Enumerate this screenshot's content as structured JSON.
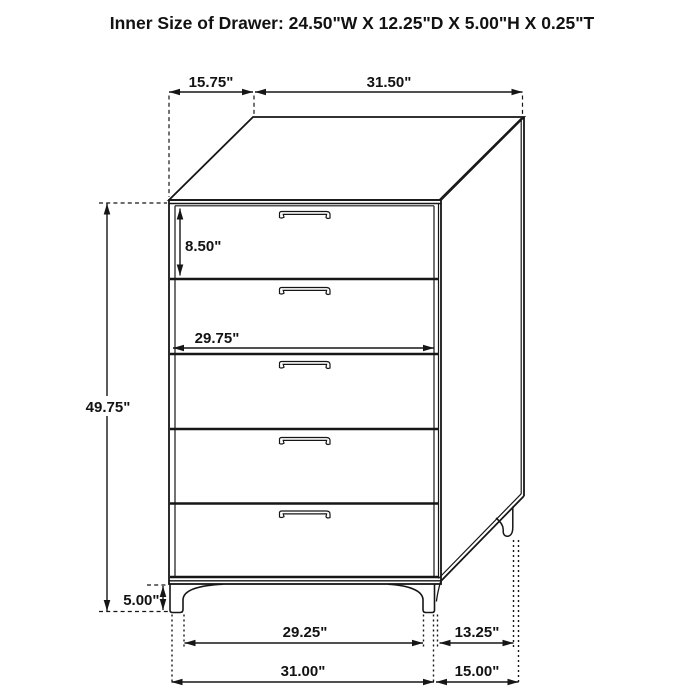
{
  "title": "Inner Size of Drawer: 24.50\"W X 12.25\"D X 5.00\"H X 0.25\"T",
  "dims": {
    "top_depth": "15.75\"",
    "top_width": "31.50\"",
    "drawer_height": "8.50\"",
    "drawer_width": "29.75\"",
    "overall_height": "49.75\"",
    "leg_height": "5.00\"",
    "front_leg_span": "29.25\"",
    "overall_width": "31.00\"",
    "side_leg_span": "13.25\"",
    "overall_depth": "15.00\""
  },
  "figure": {
    "type": "dimension-diagram",
    "object": "5-drawer chest",
    "drawer_count": 5
  },
  "colors": {
    "line": "#161616",
    "background": "#ffffff"
  }
}
